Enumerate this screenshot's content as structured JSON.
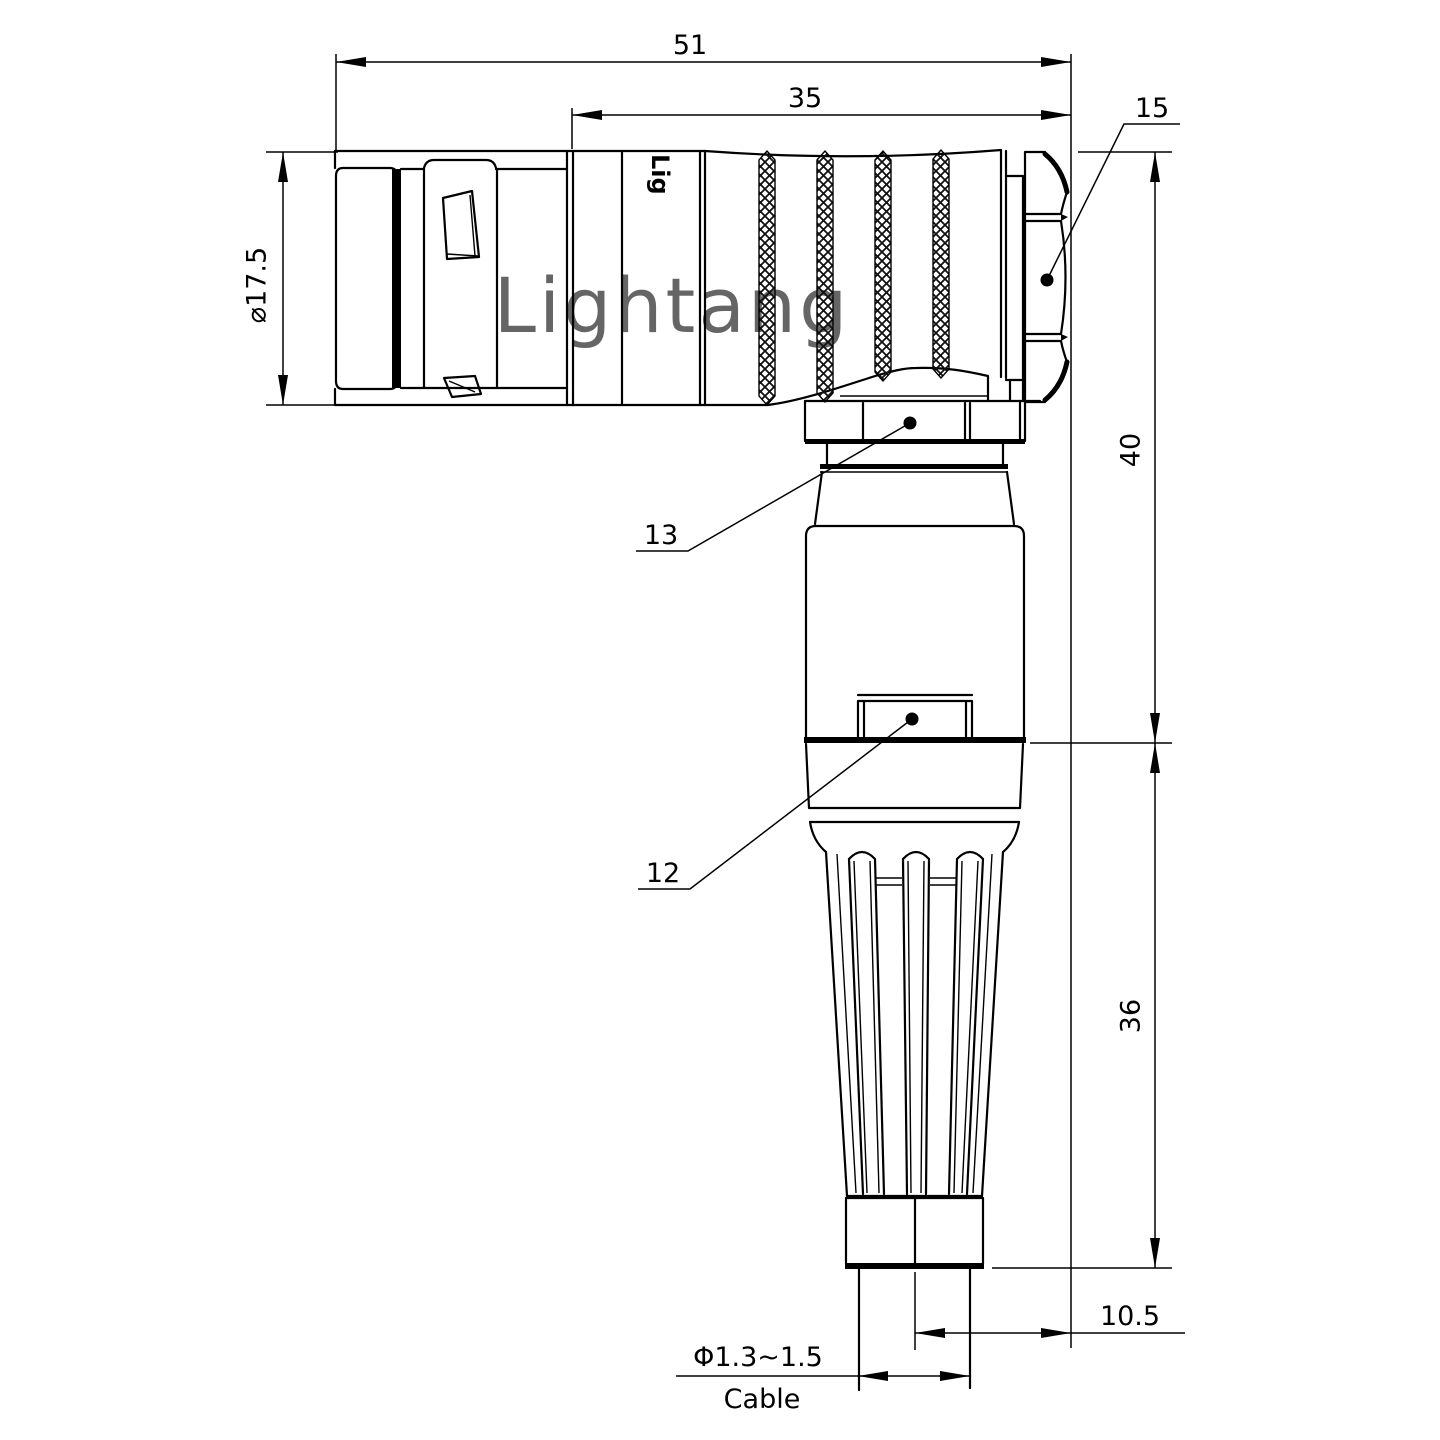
{
  "drawing": {
    "title": "Right-angle connector technical drawing",
    "dims": {
      "overall_length": "51",
      "body_length": "35",
      "plug_diameter": "⌀17.5",
      "height_upper": "40",
      "height_lower": "36",
      "offset": "10.5",
      "cable_diameter": "Φ1.3~1.5",
      "cable_label": "Cable"
    },
    "part_labels": {
      "hex_nut": "15",
      "coupling_ring": "13",
      "housing": "12"
    },
    "watermark": "Lightang",
    "engraving": "Lig",
    "colors": {
      "line": "#000000",
      "watermark": "#efc0c0",
      "background": "#ffffff"
    }
  }
}
